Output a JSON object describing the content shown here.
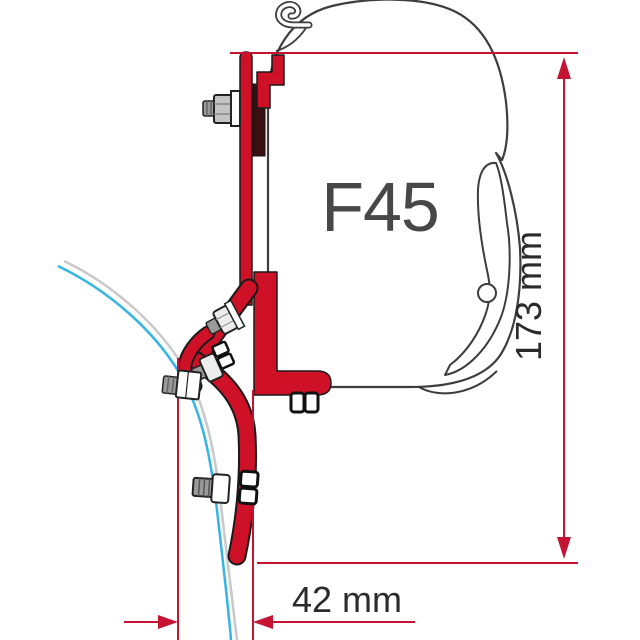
{
  "diagram": {
    "product_label": "F45",
    "dimensions": {
      "height": "173 mm",
      "depth": "42 mm"
    },
    "colors": {
      "bracket_red": "#CE1126",
      "dimension_red": "#C41432",
      "wall_profile_cyan": "#35B4E5",
      "wall_profile_gray": "#C9C9C9",
      "case_outline_gray": "#3D3D3D",
      "bolt_gray": "#9A9A9A",
      "label_dark": "#2B2B2B"
    }
  }
}
